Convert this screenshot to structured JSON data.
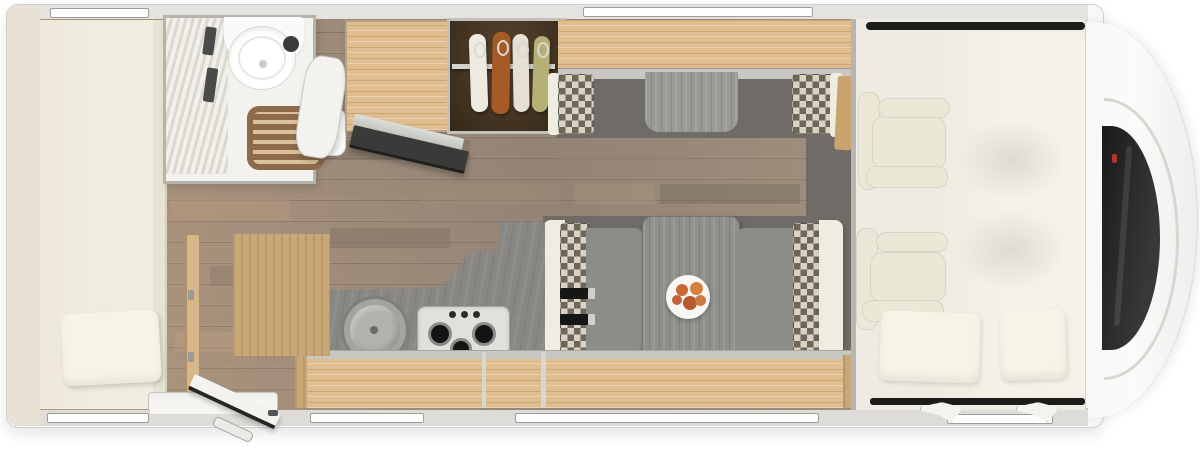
{
  "scene": {
    "title": "Motorhome floor plan, top-down view",
    "view": "top-down",
    "areas": [
      {
        "name": "rear-bedroom",
        "items": [
          "longitudinal-bed",
          "pillow"
        ]
      },
      {
        "name": "bathroom",
        "items": [
          "pleated-shower-door",
          "toilet",
          "wooden-shower-mat",
          "washbasin",
          "open-door"
        ]
      },
      {
        "name": "wardrobe",
        "items": [
          "hanging-rail",
          "garment-white",
          "garment-orange",
          "garment-cream",
          "garment-green"
        ]
      },
      {
        "name": "kitchen",
        "items": [
          "tall-cabinet-fridge",
          "tv-on-bracket",
          "worktop",
          "round-sink-with-lid",
          "gas-hob-3-burner",
          "base-lockers"
        ]
      },
      {
        "name": "dinette",
        "items": [
          "side-sofa",
          "bench-left-with-seatbelts",
          "bench-right",
          "table",
          "plate-of-food"
        ]
      },
      {
        "name": "cab",
        "items": [
          "driver-seat",
          "passenger-seat",
          "drop-down-bed",
          "pillow-left",
          "pillow-right",
          "side-mirrors",
          "windshield"
        ]
      }
    ],
    "windows": {
      "top_wall": 2,
      "bottom_wall": 4
    },
    "entry_door_state": "open",
    "seat_belt_count": 2,
    "burner_count": 3,
    "garment_count": 4
  },
  "palette": {
    "page_bg": "#ffffff",
    "shell": "#f8f8f6",
    "shell_border": "#d0d0cd",
    "band_top": "#e4e3df",
    "band_bottom": "#dddcd8",
    "band_left": "#e8e2d5",
    "window_fill": "#fefefe",
    "window_border": "#9d9d9a",
    "floor_base": "#a08b79",
    "floor_dark": "#6f6b66",
    "bed": "#f0ecdf",
    "bed_board": "#e7e2d2",
    "pillow": "#f7f3e7",
    "bath_floor": "#f3f2ee",
    "bath_wall": "#b5b3ae",
    "pleat_light": "#f2f0ea",
    "pleat_dark": "#dbd8cf",
    "toilet": "#ffffff",
    "toilet_cap": "#3b3b39",
    "shower_base": "#8d6b4a",
    "shower_slat": "#dcc19a",
    "wood": "#e0bd8e",
    "wood_dark": "#c9a26d",
    "wardrobe_in": "#342818",
    "rail": "#d6d4cf",
    "garment1": "#eeeae0",
    "garment2": "#a65a26",
    "garment3": "#e4e0d3",
    "garment4": "#b5b075",
    "cab_lip": "#c9c7c1",
    "checker_light": "#d8d3c6",
    "checker_dark": "#6e6758",
    "bench_gray": "#8c8c88",
    "bench_shell": "#efece2",
    "table": "#8f8f8b",
    "plate": "#f8f7f5",
    "food": "#c96a34",
    "belt": "#161614",
    "buckle": "#cfcfcb",
    "counter": "#898783",
    "sink": "#a5a39f",
    "sink_lid": "#b3b1ad",
    "stove": "#e0e0dc",
    "burner": "#141414",
    "cab_floor": "#eeebe2",
    "cab_bed": "#f4f1e8",
    "seat_cream": "#ece8d8",
    "dark_line": "#1c1c1a",
    "windshield": "#1a1a1a",
    "chrome": "#d6d6d2",
    "red_badge": "#b33527",
    "tv_dark": "#3a3a38",
    "tv_silver": "#dcdcd8",
    "entry_wood": "#c9a877",
    "door_white": "#f3f2ee"
  }
}
